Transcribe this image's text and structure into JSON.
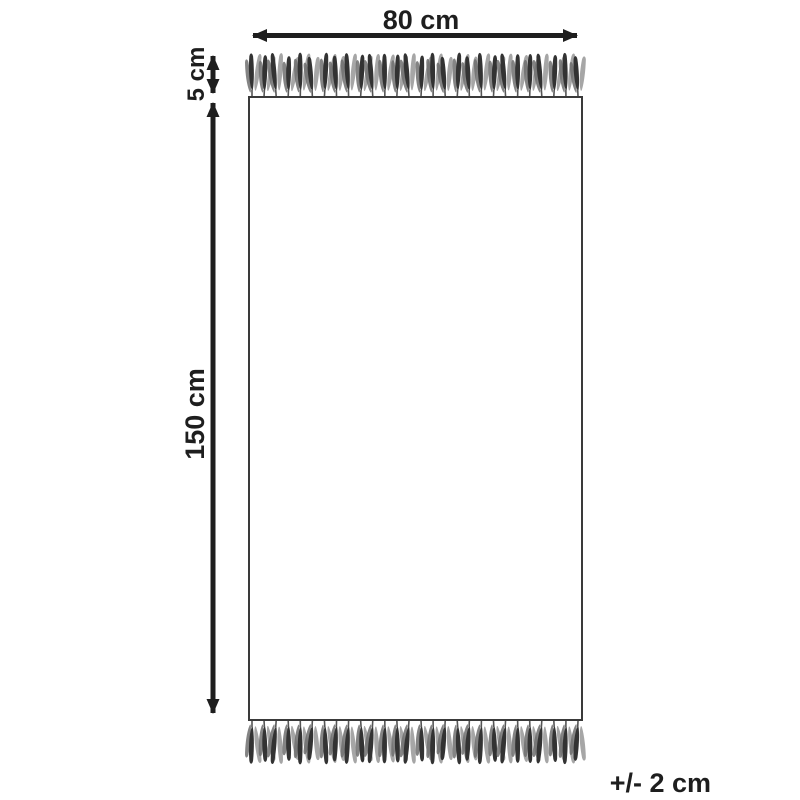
{
  "diagram": {
    "title": "rug-dimension-diagram",
    "width_label": "80 cm",
    "fringe_label": "5 cm",
    "length_label": "150 cm",
    "tolerance_label": "+/- 2 cm",
    "colors": {
      "background": "#ffffff",
      "line": "#1e1e1e",
      "rect_border": "#3a3a3a",
      "tassel_dark": "#333333",
      "tassel_mid": "#6f6f6f",
      "tassel_light": "#9c9c9c",
      "stem": "#555555"
    },
    "fringe": {
      "count_top": 28,
      "count_bottom": 28
    }
  }
}
